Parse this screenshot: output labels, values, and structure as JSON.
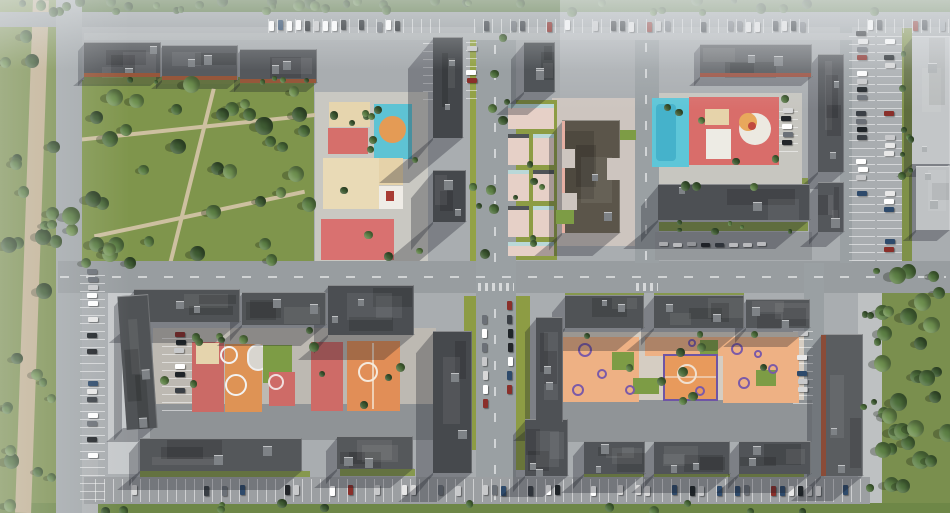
{
  "meta": {
    "view": "aerial-render-residential-masterplan",
    "canvas": {
      "w": 950,
      "h": 513
    }
  },
  "palette": {
    "ground": "#a9adb0",
    "road": "#9ba0a3",
    "park_green": "#7d9150",
    "lawn_green": "#93a246",
    "roof_dark": "#4b4e52",
    "roof_light": "#c3c6c8",
    "terracotta": "#96573b",
    "play_red": "#d66f6b",
    "play_cyan": "#5ec6d8",
    "play_orange": "#eeb184",
    "play_sand": "#e6d5ae",
    "play_purple": "#7b5aa8",
    "car_colors": [
      "#ffffff",
      "#e8e8e8",
      "#1f2428",
      "#6b7077",
      "#9aa0a6",
      "#8a2f2a",
      "#2e4a6b",
      "#c8c9cb",
      "#3a3f45",
      "#d8d8d8",
      "#ffffff",
      "#23262a"
    ]
  },
  "greens": [
    [
      0,
      0,
      950,
      13,
      "#5a7644"
    ],
    [
      0,
      0,
      57,
      513,
      "#7d9150"
    ],
    [
      62,
      80,
      252,
      186,
      "#7f954c"
    ],
    [
      470,
      33,
      42,
      228,
      "#93a246"
    ],
    [
      902,
      28,
      10,
      233,
      "#7f9149"
    ],
    [
      878,
      263,
      72,
      250,
      "#7a8f4e"
    ],
    [
      0,
      503,
      950,
      10,
      "#6e8747"
    ],
    [
      516,
      296,
      14,
      174,
      "#8d9c44"
    ],
    [
      464,
      296,
      14,
      120,
      "#8d9c44"
    ],
    [
      450,
      390,
      26,
      60,
      "#8d9c44"
    ],
    [
      658,
      222,
      150,
      9,
      "#7f9149"
    ],
    [
      84,
      77,
      230,
      7,
      "#86984e"
    ],
    [
      140,
      471,
      170,
      7,
      "#86984e"
    ],
    [
      340,
      469,
      75,
      7,
      "#86984e"
    ],
    [
      584,
      474,
      60,
      6,
      "#86984e"
    ],
    [
      654,
      474,
      76,
      6,
      "#86984e"
    ],
    [
      739,
      474,
      72,
      6,
      "#86984e"
    ],
    [
      565,
      288,
      79,
      7,
      "#86984e"
    ],
    [
      654,
      288,
      90,
      7,
      "#86984e"
    ],
    [
      658,
      178,
      150,
      6,
      "#86984e"
    ]
  ],
  "paths": [
    [
      24,
      0,
      16,
      513,
      "#c3b192",
      2
    ],
    [
      66,
      126,
      250,
      4,
      "#cdc0a0",
      -6
    ],
    [
      92,
      212,
      215,
      4,
      "#cdc0a0",
      -12
    ],
    [
      190,
      86,
      4,
      180,
      "#cdc0a0",
      14
    ],
    [
      56,
      460,
      42,
      53,
      "#b0b3b5",
      0
    ]
  ],
  "plazas": [
    [
      108,
      288,
      30,
      186,
      "#c6c9cb"
    ],
    [
      858,
      266,
      24,
      237,
      "#bec1c2"
    ],
    [
      315,
      92,
      113,
      172,
      "#c9c8c2"
    ],
    [
      650,
      93,
      152,
      99,
      "#c7c6c0"
    ],
    [
      153,
      328,
      283,
      84,
      "#bdb9b2"
    ],
    [
      562,
      332,
      250,
      76,
      "#d5cdc2"
    ],
    [
      552,
      98,
      100,
      148,
      "#cdc5bf"
    ],
    [
      505,
      100,
      52,
      160,
      "#8d9c44"
    ]
  ],
  "roads": [
    [
      0,
      12,
      950,
      15,
      "#9ba0a3"
    ],
    [
      56,
      0,
      26,
      513,
      "#a4a9ac"
    ],
    [
      58,
      261,
      892,
      32,
      "#989da0"
    ],
    [
      476,
      27,
      40,
      476,
      "#9aa0a3"
    ],
    [
      635,
      27,
      24,
      236,
      "#9aa0a3"
    ],
    [
      804,
      263,
      20,
      240,
      "#9aa0a3"
    ],
    [
      840,
      27,
      12,
      236,
      "#9aa0a3"
    ],
    [
      84,
      477,
      786,
      27,
      "#9c9fa2"
    ],
    [
      150,
      404,
      312,
      36,
      "#8f9396"
    ],
    [
      560,
      400,
      252,
      42,
      "#909497"
    ],
    [
      655,
      232,
      157,
      28,
      "#95999c"
    ],
    [
      84,
      33,
      784,
      7,
      "#b0b4b6"
    ]
  ],
  "markings": [
    {
      "x": 60,
      "y": 276,
      "w": 886,
      "h": 2,
      "dir": "h"
    },
    {
      "x": 494,
      "y": 30,
      "w": 2,
      "h": 232,
      "dir": "v"
    },
    {
      "x": 494,
      "y": 300,
      "w": 2,
      "h": 200,
      "dir": "v"
    },
    {
      "x": 645,
      "y": 30,
      "w": 2,
      "h": 230,
      "dir": "v"
    },
    {
      "x": 478,
      "y": 283,
      "w": 36,
      "h": 8,
      "dir": "cwv"
    },
    {
      "x": 636,
      "y": 283,
      "w": 22,
      "h": 8,
      "dir": "cwv"
    }
  ],
  "parking_lots": [
    {
      "x": 268,
      "y": 19,
      "w": 180,
      "h": 14,
      "o": "h",
      "n": 13,
      "lines": true
    },
    {
      "x": 474,
      "y": 19,
      "w": 110,
      "h": 14,
      "o": "h",
      "n": 5,
      "lines": true
    },
    {
      "x": 592,
      "y": 19,
      "w": 100,
      "h": 14,
      "o": "h",
      "n": 7,
      "lines": true
    },
    {
      "x": 700,
      "y": 19,
      "w": 115,
      "h": 14,
      "o": "h",
      "n": 9,
      "lines": true
    },
    {
      "x": 858,
      "y": 19,
      "w": 92,
      "h": 14,
      "o": "h",
      "n": 5,
      "lines": true
    },
    {
      "x": 849,
      "y": 30,
      "w": 26,
      "h": 231,
      "o": "v",
      "n": 16,
      "lines": true
    },
    {
      "x": 877,
      "y": 30,
      "w": 25,
      "h": 231,
      "o": "v",
      "n": 15,
      "lines": true
    },
    {
      "x": 80,
      "y": 268,
      "w": 25,
      "h": 232,
      "o": "v",
      "n": 15,
      "lines": true
    },
    {
      "x": 95,
      "y": 479,
      "w": 768,
      "h": 23,
      "o": "h",
      "n": 36,
      "lines": true
    },
    {
      "x": 479,
      "y": 300,
      "w": 12,
      "h": 168,
      "o": "v",
      "n": 7,
      "lines": false,
      "cw": 5,
      "ch": 9,
      "slot": 14
    },
    {
      "x": 504,
      "y": 300,
      "w": 12,
      "h": 168,
      "o": "v",
      "n": 7,
      "lines": false,
      "cw": 5,
      "ch": 9,
      "slot": 14
    },
    {
      "x": 466,
      "y": 37,
      "w": 11,
      "h": 62,
      "o": "v",
      "n": 4,
      "lines": true
    },
    {
      "x": 423,
      "y": 38,
      "w": 10,
      "h": 62,
      "o": "v",
      "n": 3,
      "lines": true
    },
    {
      "x": 776,
      "y": 107,
      "w": 22,
      "h": 45,
      "o": "v",
      "n": 6,
      "lines": true
    },
    {
      "x": 658,
      "y": 237,
      "w": 150,
      "h": 15,
      "o": "h",
      "n": 8,
      "lines": false,
      "cw": 9,
      "ch": 4,
      "slot": 14
    },
    {
      "x": 162,
      "y": 331,
      "w": 36,
      "h": 80,
      "o": "v",
      "n": 6,
      "lines": true
    },
    {
      "x": 793,
      "y": 330,
      "w": 20,
      "h": 74,
      "o": "v",
      "n": 5,
      "lines": true
    },
    {
      "x": 128,
      "y": 301,
      "w": 11,
      "h": 130,
      "o": "v",
      "n": 6,
      "lines": false,
      "cw": 5,
      "ch": 8,
      "slot": 16
    }
  ],
  "buildings": [
    {
      "x": 84,
      "y": 42,
      "w": 77,
      "h": 35,
      "c": "#55585c",
      "sh": 10,
      "acc": {
        "s": "b",
        "c": "#96573b",
        "t": 4
      }
    },
    {
      "x": 162,
      "y": 45,
      "w": 76,
      "h": 35,
      "c": "#585b5f",
      "sh": 10,
      "acc": {
        "s": "b",
        "c": "#96573b",
        "t": 4
      }
    },
    {
      "x": 240,
      "y": 49,
      "w": 77,
      "h": 34,
      "c": "#55585c",
      "sh": 10,
      "acc": {
        "s": "b",
        "c": "#96573b",
        "t": 4
      }
    },
    {
      "x": 433,
      "y": 37,
      "w": 30,
      "h": 101,
      "c": "#43464a",
      "sh": 46
    },
    {
      "x": 433,
      "y": 170,
      "w": 33,
      "h": 52,
      "c": "#45484c",
      "sh": 40
    },
    {
      "x": 524,
      "y": 42,
      "w": 31,
      "h": 50,
      "c": "#505458",
      "sh": 24
    },
    {
      "x": 562,
      "y": 120,
      "w": 58,
      "h": 113,
      "c": "#5b554a",
      "sh": 24,
      "acc": {
        "s": "l",
        "c": "#e5afa3",
        "t": 3
      }
    },
    {
      "x": 700,
      "y": 44,
      "w": 112,
      "h": 33,
      "c": "#5d6064",
      "sh": 10,
      "acc": {
        "s": "b",
        "c": "#9a5040",
        "t": 4
      }
    },
    {
      "x": 818,
      "y": 54,
      "w": 26,
      "h": 118,
      "c": "#54575b",
      "sh": 18
    },
    {
      "x": 818,
      "y": 182,
      "w": 26,
      "h": 50,
      "c": "#54575b",
      "sh": 16
    },
    {
      "x": 658,
      "y": 184,
      "w": 152,
      "h": 36,
      "c": "#4d5054",
      "sh": 30
    },
    {
      "x": 912,
      "y": 36,
      "w": 38,
      "h": 128,
      "c": "#c3c6c8",
      "sh": 14,
      "lt": 1
    },
    {
      "x": 916,
      "y": 166,
      "w": 34,
      "h": 64,
      "c": "#bfc2c4",
      "sh": 12,
      "lt": 1
    },
    {
      "x": 134,
      "y": 289,
      "w": 106,
      "h": 33,
      "c": "#505356",
      "sh": 22
    },
    {
      "x": 242,
      "y": 292,
      "w": 84,
      "h": 33,
      "c": "#525558",
      "sh": 22
    },
    {
      "x": 328,
      "y": 285,
      "w": 86,
      "h": 50,
      "c": "#4b4e52",
      "sh": 26
    },
    {
      "x": 433,
      "y": 331,
      "w": 39,
      "h": 142,
      "c": "#46494d",
      "sh": 30
    },
    {
      "x": 122,
      "y": 295,
      "w": 31,
      "h": 134,
      "c": "#505356",
      "sh": 14,
      "rot": -4
    },
    {
      "x": 140,
      "y": 438,
      "w": 162,
      "h": 33,
      "c": "#54575a",
      "sh": 20
    },
    {
      "x": 337,
      "y": 436,
      "w": 76,
      "h": 33,
      "c": "#55585b",
      "sh": 20
    },
    {
      "x": 525,
      "y": 419,
      "w": 43,
      "h": 57,
      "c": "#4e5155",
      "sh": 22
    },
    {
      "x": 536,
      "y": 317,
      "w": 27,
      "h": 105,
      "c": "#4e5155",
      "sh": 20
    },
    {
      "x": 565,
      "y": 295,
      "w": 79,
      "h": 33,
      "c": "#505356",
      "sh": 24
    },
    {
      "x": 654,
      "y": 295,
      "w": 90,
      "h": 33,
      "c": "#505356",
      "sh": 24
    },
    {
      "x": 746,
      "y": 299,
      "w": 64,
      "h": 29,
      "c": "#54575a",
      "sh": 20
    },
    {
      "x": 584,
      "y": 441,
      "w": 61,
      "h": 33,
      "c": "#515458",
      "sh": 20
    },
    {
      "x": 654,
      "y": 441,
      "w": 76,
      "h": 33,
      "c": "#515458",
      "sh": 20
    },
    {
      "x": 739,
      "y": 441,
      "w": 72,
      "h": 33,
      "c": "#515458",
      "sh": 20
    },
    {
      "x": 821,
      "y": 334,
      "w": 42,
      "h": 142,
      "c": "#5a5d60",
      "sh": 26,
      "acc": {
        "s": "l",
        "c": "#8a4c38",
        "t": 5
      }
    }
  ],
  "playgrounds": [
    {
      "x": 329,
      "y": 102,
      "w": 41,
      "h": 25,
      "c": "#e6d5ae"
    },
    {
      "x": 328,
      "y": 128,
      "w": 40,
      "h": 26,
      "c": "#d66f6b"
    },
    {
      "x": 374,
      "y": 104,
      "w": 38,
      "h": 55,
      "c": "#5ec3d4"
    },
    {
      "x": 379,
      "y": 116,
      "w": 27,
      "h": 27,
      "c": "#e49b55",
      "shape": "circle"
    },
    {
      "x": 323,
      "y": 158,
      "w": 56,
      "h": 51,
      "c": "#e9dab6"
    },
    {
      "x": 379,
      "y": 158,
      "w": 24,
      "h": 27,
      "c": "#e5d2a9"
    },
    {
      "x": 379,
      "y": 186,
      "w": 24,
      "h": 23,
      "c": "#efece6"
    },
    {
      "x": 321,
      "y": 219,
      "w": 73,
      "h": 41,
      "c": "#d97170"
    },
    {
      "x": 652,
      "y": 98,
      "w": 37,
      "h": 69,
      "c": "#5ec6d8"
    },
    {
      "x": 656,
      "y": 104,
      "w": 20,
      "h": 57,
      "c": "#45b2cb",
      "br": 4
    },
    {
      "x": 689,
      "y": 97,
      "w": 90,
      "h": 68,
      "c": "#d96d6a"
    },
    {
      "x": 705,
      "y": 109,
      "w": 24,
      "h": 16,
      "c": "#e6d3aa"
    },
    {
      "x": 706,
      "y": 129,
      "w": 25,
      "h": 30,
      "c": "#edebe4"
    },
    {
      "x": 739,
      "y": 113,
      "w": 32,
      "h": 32,
      "c": "#ece9e1",
      "shape": "circle"
    },
    {
      "x": 192,
      "y": 342,
      "w": 32,
      "h": 70,
      "c": "#cb6a66"
    },
    {
      "x": 196,
      "y": 343,
      "w": 23,
      "h": 21,
      "c": "#e5d4ad"
    },
    {
      "x": 225,
      "y": 344,
      "w": 37,
      "h": 68,
      "c": "#de9355"
    },
    {
      "x": 247,
      "y": 344,
      "w": 22,
      "h": 27,
      "c": "#d8d5cf",
      "bd": "2px solid #eeeeee",
      "br": 11
    },
    {
      "x": 263,
      "y": 345,
      "w": 29,
      "h": 38,
      "c": "#7d9c45"
    },
    {
      "x": 269,
      "y": 372,
      "w": 26,
      "h": 34,
      "c": "#ce6b67"
    },
    {
      "x": 311,
      "y": 342,
      "w": 32,
      "h": 69,
      "c": "#ce6b67"
    },
    {
      "x": 347,
      "y": 341,
      "w": 53,
      "h": 70,
      "c": "#e18e57"
    },
    {
      "x": 563,
      "y": 337,
      "w": 76,
      "h": 65,
      "c": "#eeb184"
    },
    {
      "x": 645,
      "y": 337,
      "w": 115,
      "h": 19,
      "c": "#eeb184"
    },
    {
      "x": 663,
      "y": 354,
      "w": 55,
      "h": 47,
      "c": "#e89a5c",
      "bd": "2px solid #6f55a5"
    },
    {
      "x": 723,
      "y": 337,
      "w": 76,
      "h": 66,
      "c": "#eeb184"
    },
    {
      "x": 612,
      "y": 352,
      "w": 22,
      "h": 18,
      "c": "#7d9c45"
    },
    {
      "x": 633,
      "y": 378,
      "w": 26,
      "h": 16,
      "c": "#7d9c45"
    },
    {
      "x": 700,
      "y": 340,
      "w": 18,
      "h": 14,
      "c": "#7d9c45"
    },
    {
      "x": 756,
      "y": 370,
      "w": 20,
      "h": 16,
      "c": "#7d9c45"
    }
  ],
  "court_markings": [
    {
      "x": 386,
      "y": 191,
      "w": 8,
      "h": 10,
      "c": "#a83c34"
    },
    {
      "x": 748,
      "y": 122,
      "r": 9,
      "c": "#e8a85c"
    },
    {
      "x": 752,
      "y": 126,
      "r": 4,
      "c": "#c04a40"
    },
    {
      "x": 229,
      "y": 355,
      "r": 9,
      "ring": "#f2f2f2"
    },
    {
      "x": 236,
      "y": 385,
      "r": 11,
      "ring": "#f2f2f2"
    },
    {
      "x": 276,
      "y": 382,
      "r": 8,
      "ring": "#f0dede"
    },
    {
      "x": 368,
      "y": 372,
      "r": 10,
      "ring": "#f5e9dc"
    },
    {
      "x": 372,
      "y": 343,
      "w": 2,
      "h": 66,
      "c": "rgba(245,235,220,0.7)"
    },
    {
      "x": 687,
      "y": 374,
      "r": 10,
      "ring": "#f0e0d0"
    },
    {
      "x": 665,
      "y": 376,
      "w": 51,
      "h": 2,
      "c": "rgba(240,225,210,0.6)"
    },
    {
      "x": 585,
      "y": 350,
      "r": 7,
      "ring": "#7b5aa8"
    },
    {
      "x": 602,
      "y": 374,
      "r": 5,
      "ring": "#7b5aa8"
    },
    {
      "x": 578,
      "y": 390,
      "r": 6,
      "ring": "#7b5aa8"
    },
    {
      "x": 630,
      "y": 390,
      "r": 5,
      "ring": "#7b5aa8"
    },
    {
      "x": 692,
      "y": 343,
      "r": 4,
      "ring": "#7b5aa8"
    },
    {
      "x": 737,
      "y": 349,
      "r": 6,
      "ring": "#7b5aa8"
    },
    {
      "x": 758,
      "y": 354,
      "r": 4,
      "ring": "#7b5aa8"
    },
    {
      "x": 744,
      "y": 383,
      "r": 6,
      "ring": "#7b5aa8"
    },
    {
      "x": 773,
      "y": 369,
      "r": 5,
      "ring": "#7b5aa8"
    },
    {
      "x": 700,
      "y": 391,
      "r": 5,
      "ring": "#7b5aa8"
    }
  ],
  "mall": {
    "cell_color": "#e6d0c7",
    "teal_bar": "#b9d8d8",
    "dark_bar": "#4f5357",
    "cells": [
      {
        "x": 508,
        "y": 104,
        "w": 46,
        "h": 25,
        "bar": "teal"
      },
      {
        "x": 508,
        "y": 134,
        "w": 21,
        "h": 31,
        "bar": "dark"
      },
      {
        "x": 533,
        "y": 134,
        "w": 21,
        "h": 31,
        "bar": "teal"
      },
      {
        "x": 508,
        "y": 170,
        "w": 21,
        "h": 31,
        "bar": "teal"
      },
      {
        "x": 533,
        "y": 170,
        "w": 21,
        "h": 31,
        "bar": "dark"
      },
      {
        "x": 508,
        "y": 206,
        "w": 21,
        "h": 31,
        "bar": "dark"
      },
      {
        "x": 533,
        "y": 206,
        "w": 21,
        "h": 31,
        "bar": "teal"
      },
      {
        "x": 508,
        "y": 242,
        "w": 46,
        "h": 14,
        "bar": "teal"
      }
    ]
  },
  "overlays": [
    [
      562,
      149,
      13,
      19,
      "#cdc5bf"
    ],
    [
      562,
      193,
      15,
      17,
      "#cdc5bf"
    ],
    [
      607,
      158,
      13,
      22,
      "#cdc5bf"
    ],
    [
      556,
      210,
      18,
      14,
      "#7d9c45"
    ],
    [
      620,
      130,
      16,
      10,
      "#7d9c45"
    ]
  ],
  "tree_zones": [
    {
      "x": 0,
      "y": 0,
      "w": 950,
      "h": 13,
      "n": 40,
      "r0": 3,
      "r1": 6,
      "small": 1
    },
    {
      "x": 2,
      "y": 12,
      "w": 54,
      "h": 496,
      "n": 26,
      "r0": 4,
      "r1": 8,
      "small": 0
    },
    {
      "x": 64,
      "y": 84,
      "w": 248,
      "h": 180,
      "n": 40,
      "r0": 5,
      "r1": 9,
      "small": 0
    },
    {
      "x": 880,
      "y": 265,
      "w": 68,
      "h": 246,
      "n": 30,
      "r0": 5,
      "r1": 9,
      "small": 0
    },
    {
      "x": 92,
      "y": 503,
      "w": 760,
      "h": 9,
      "n": 12,
      "r0": 3,
      "r1": 5,
      "small": 1
    },
    {
      "x": 318,
      "y": 94,
      "w": 108,
      "h": 166,
      "n": 13,
      "r0": 3,
      "r1": 5,
      "small": 1
    },
    {
      "x": 652,
      "y": 96,
      "w": 148,
      "h": 92,
      "n": 9,
      "r0": 3,
      "r1": 5,
      "small": 1
    },
    {
      "x": 156,
      "y": 330,
      "w": 278,
      "h": 78,
      "n": 13,
      "r0": 3,
      "r1": 5,
      "small": 1
    },
    {
      "x": 564,
      "y": 334,
      "w": 246,
      "h": 70,
      "n": 11,
      "r0": 3,
      "r1": 5,
      "small": 1
    },
    {
      "x": 470,
      "y": 36,
      "w": 40,
      "h": 222,
      "n": 10,
      "r0": 3,
      "r1": 5,
      "small": 1
    },
    {
      "x": 506,
      "y": 102,
      "w": 50,
      "h": 156,
      "n": 6,
      "r0": 2,
      "r1": 4,
      "small": 1
    },
    {
      "x": 902,
      "y": 30,
      "w": 10,
      "h": 230,
      "n": 8,
      "r0": 2,
      "r1": 4,
      "small": 1
    },
    {
      "x": 656,
      "y": 222,
      "w": 154,
      "h": 11,
      "n": 6,
      "r0": 2,
      "r1": 4,
      "small": 1
    },
    {
      "x": 858,
      "y": 268,
      "w": 20,
      "h": 233,
      "n": 7,
      "r0": 3,
      "r1": 4,
      "small": 1
    },
    {
      "x": 84,
      "y": 76,
      "w": 230,
      "h": 7,
      "n": 6,
      "r0": 2,
      "r1": 3,
      "small": 1
    }
  ]
}
